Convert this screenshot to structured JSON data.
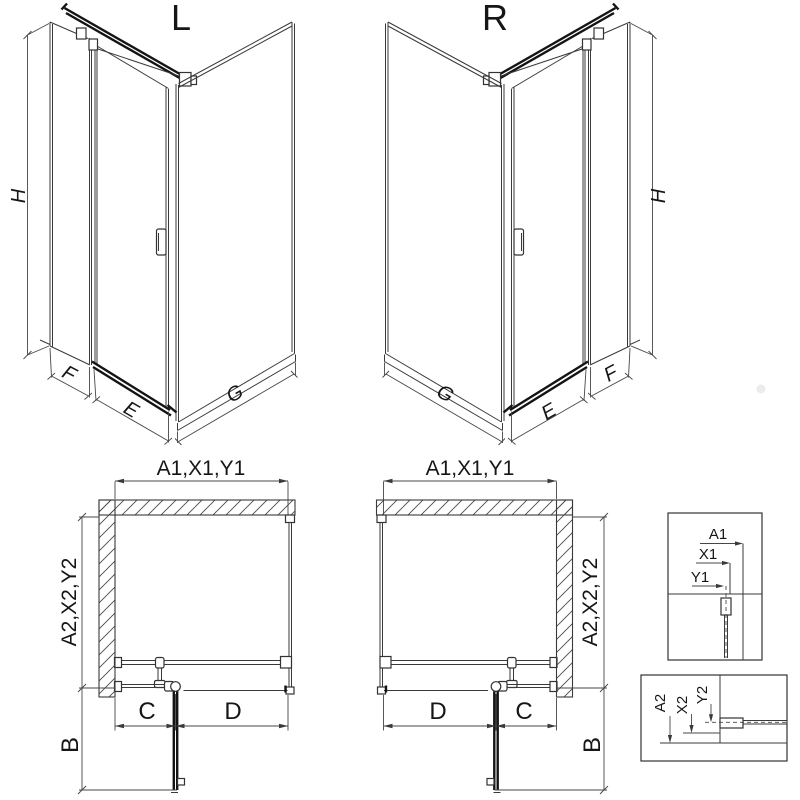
{
  "iso_left": {
    "title": "L",
    "h": "H",
    "f": "F",
    "e": "E",
    "g": "G"
  },
  "iso_right": {
    "title": "R",
    "h": "H",
    "f": "F",
    "e": "E",
    "g": "G"
  },
  "plan_left": {
    "width_dim": "A1,X1,Y1",
    "depth_dim": "A2,X2,Y2",
    "c": "C",
    "d": "D",
    "b": "B"
  },
  "plan_right": {
    "width_dim": "A1,X1,Y1",
    "depth_dim": "A2,X2,Y2",
    "c": "C",
    "d": "D",
    "b": "B"
  },
  "detail_top": {
    "a1": "A1",
    "x1": "X1",
    "y1": "Y1"
  },
  "detail_bottom": {
    "a2": "A2",
    "x2": "X2",
    "y2": "Y2"
  },
  "colors": {
    "line": "#3a3a3a",
    "dark": "#141414",
    "text": "#161616",
    "background": "#ffffff"
  }
}
